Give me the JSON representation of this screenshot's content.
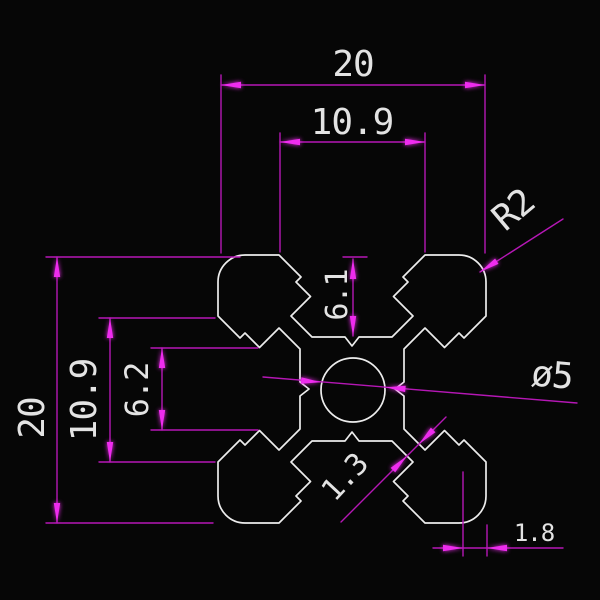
{
  "drawing": {
    "colors": {
      "background": "#060606",
      "line": "#ededed",
      "dim": "#b517b5",
      "arrow": "#ee2cee",
      "text": "#e3e3e3"
    },
    "dimensions": {
      "top_width": "20",
      "top_slot_mouth": "10.9",
      "left_height": "20",
      "left_slot_mouth": "10.9",
      "left_slot_throat": "6.2",
      "slot_depth": "6.1",
      "corner_radius": "R2",
      "center_bore": "ø5",
      "web_thickness": "1.3",
      "lip_wall": "1.8"
    }
  }
}
